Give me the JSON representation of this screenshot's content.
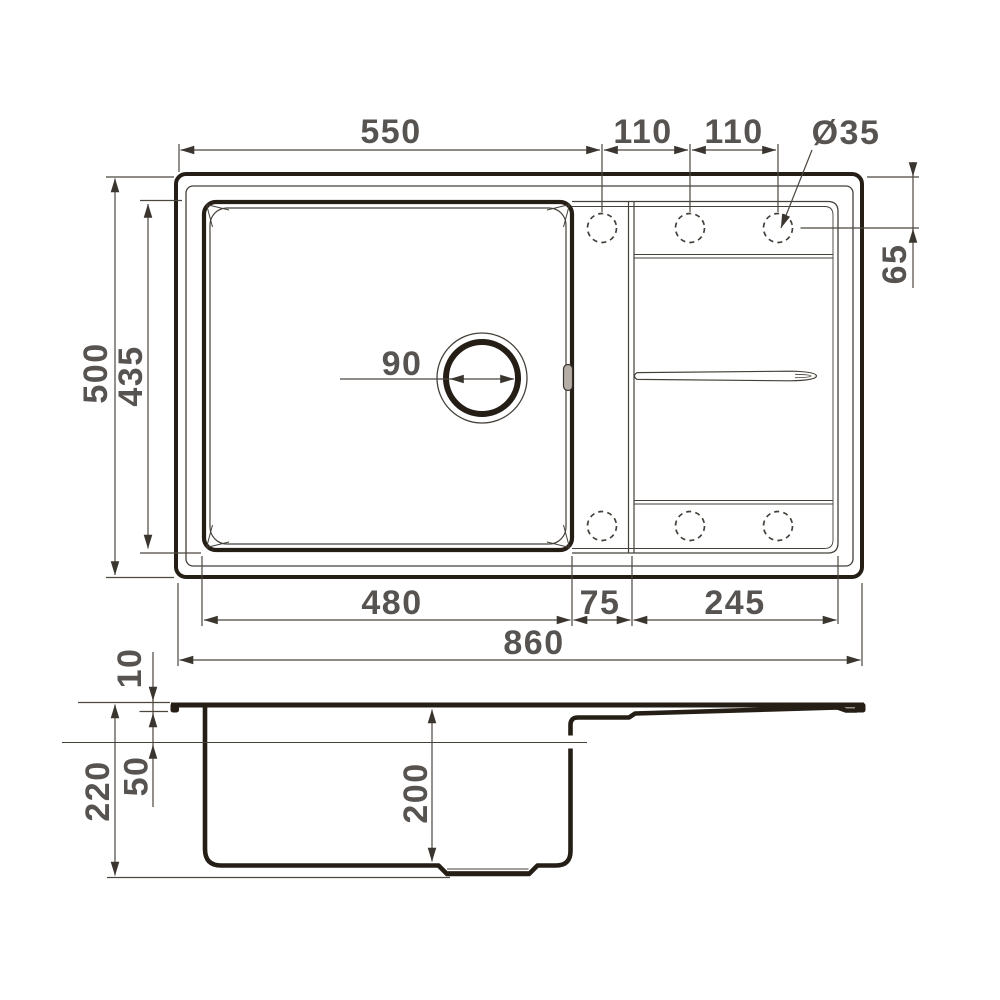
{
  "drawing": {
    "colors": {
      "background": "#ffffff",
      "line_heavy": "#241e16",
      "line_light": "#45403a",
      "dimension_line": "#4c463f",
      "arrow": "#3a352e",
      "text": "#575350",
      "overflow_fill": "#b5aea6"
    },
    "top_view": {
      "width_550": "550",
      "spacing_110_a": "110",
      "spacing_110_b": "110",
      "hole_diameter": "Ø35",
      "hole_offset_65": "65",
      "overall_depth_500": "500",
      "bowl_depth_435": "435",
      "drain_diameter_90": "90",
      "bowl_width_480": "480",
      "channel_width_75": "75",
      "drainboard_width_245": "245",
      "overall_width_860": "860"
    },
    "side_view": {
      "rim_height_10": "10",
      "overflow_offset_50": "50",
      "total_height_220": "220",
      "bowl_depth_200": "200"
    }
  }
}
